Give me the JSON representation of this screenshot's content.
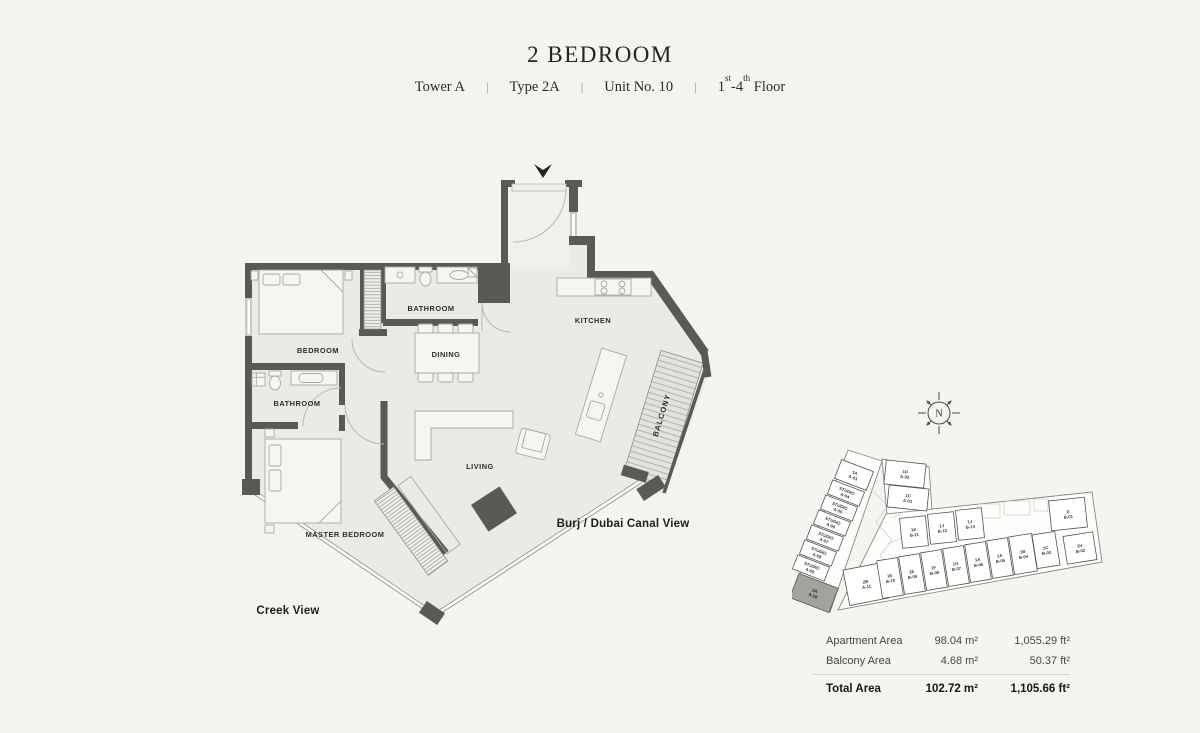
{
  "header": {
    "title": "2 BEDROOM",
    "subtitle": {
      "tower": "Tower A",
      "type": "Type 2A",
      "unit": "Unit No. 10",
      "sep": "|",
      "floor": {
        "n1": "1",
        "s1": "st",
        "n2": "-4",
        "s2": "th",
        "rest": " Floor"
      }
    }
  },
  "floorplan": {
    "rooms": {
      "bedroom": "BEDROOM",
      "bathroom1": "BATHROOM",
      "bathroom2": "BATHROOM",
      "dining": "DINING",
      "kitchen": "KITCHEN",
      "living": "LIVING",
      "master_bedroom": "MASTER BEDROOM",
      "balcony": "BALCONY"
    },
    "views": {
      "canal": "Burj / Dubai Canal View",
      "creek": "Creek View"
    }
  },
  "compass": {
    "label": "N"
  },
  "keyplan": {
    "units": [
      {
        "name": "1A",
        "code": "A-03",
        "x": 62,
        "y": 27,
        "r": 21,
        "w": 34,
        "h": 20,
        "hl": false
      },
      {
        "name": "STUDIO",
        "code": "A-04",
        "x": 54,
        "y": 45,
        "r": 21,
        "w": 34,
        "h": 15,
        "hl": false
      },
      {
        "name": "STUDIO",
        "code": "A-05",
        "x": 47,
        "y": 60,
        "r": 21,
        "w": 34,
        "h": 15,
        "hl": false
      },
      {
        "name": "STUDIO",
        "code": "A-06",
        "x": 40,
        "y": 75,
        "r": 21,
        "w": 34,
        "h": 15,
        "hl": false
      },
      {
        "name": "STUDIO",
        "code": "A-07",
        "x": 33,
        "y": 90,
        "r": 21,
        "w": 34,
        "h": 15,
        "hl": false
      },
      {
        "name": "STUDIO",
        "code": "A-08",
        "x": 26,
        "y": 105,
        "r": 21,
        "w": 34,
        "h": 15,
        "hl": false
      },
      {
        "name": "STUDIO",
        "code": "A-09",
        "x": 19,
        "y": 120,
        "r": 21,
        "w": 34,
        "h": 15,
        "hl": false
      },
      {
        "name": "2A",
        "code": "A-10",
        "x": 22,
        "y": 145,
        "r": 21,
        "w": 42,
        "h": 26,
        "hl": true
      },
      {
        "name": "1D",
        "code": "A-02",
        "x": 113,
        "y": 26,
        "r": 6,
        "w": 40,
        "h": 24,
        "hl": false
      },
      {
        "name": "1C",
        "code": "A-01",
        "x": 116,
        "y": 50,
        "r": 6,
        "w": 40,
        "h": 22,
        "hl": false
      },
      {
        "name": "1K",
        "code": "B-11",
        "x": 122,
        "y": 84,
        "r": -6,
        "w": 26,
        "h": 30,
        "hl": false
      },
      {
        "name": "1J",
        "code": "B-12",
        "x": 150,
        "y": 80,
        "r": -6,
        "w": 26,
        "h": 30,
        "hl": false
      },
      {
        "name": "1J",
        "code": "B-13",
        "x": 178,
        "y": 76,
        "r": -6,
        "w": 26,
        "h": 30,
        "hl": false
      },
      {
        "name": "1I",
        "code": "B-01",
        "x": 276,
        "y": 66,
        "r": -6,
        "w": 36,
        "h": 30,
        "hl": false
      },
      {
        "name": "2B",
        "code": "A-11",
        "x": 74,
        "y": 136,
        "r": -11,
        "w": 40,
        "h": 36,
        "hl": false
      },
      {
        "name": "1E",
        "code": "B-10",
        "x": 98,
        "y": 130,
        "r": -9,
        "w": 21,
        "h": 38,
        "hl": false
      },
      {
        "name": "1E",
        "code": "B-09",
        "x": 120,
        "y": 126,
        "r": -9,
        "w": 21,
        "h": 38,
        "hl": false
      },
      {
        "name": "1F",
        "code": "B-08",
        "x": 142,
        "y": 122,
        "r": -9,
        "w": 21,
        "h": 38,
        "hl": false
      },
      {
        "name": "1G",
        "code": "B-07",
        "x": 164,
        "y": 118,
        "r": -9,
        "w": 21,
        "h": 38,
        "hl": false
      },
      {
        "name": "1A",
        "code": "B-06",
        "x": 186,
        "y": 114,
        "r": -9,
        "w": 21,
        "h": 38,
        "hl": false
      },
      {
        "name": "1A",
        "code": "B-05",
        "x": 208,
        "y": 110,
        "r": -9,
        "w": 21,
        "h": 38,
        "hl": false
      },
      {
        "name": "1B",
        "code": "B-04",
        "x": 231,
        "y": 106,
        "r": -9,
        "w": 23,
        "h": 38,
        "hl": false
      },
      {
        "name": "1C",
        "code": "B-03",
        "x": 254,
        "y": 102,
        "r": -9,
        "w": 23,
        "h": 34,
        "hl": false
      },
      {
        "name": "1H",
        "code": "B-02",
        "x": 288,
        "y": 100,
        "r": -9,
        "w": 30,
        "h": 28,
        "hl": false
      }
    ]
  },
  "area_table": {
    "rows": [
      {
        "label": "Apartment Area",
        "m2": "98.04 m²",
        "ft2": "1,055.29 ft²"
      },
      {
        "label": "Balcony Area",
        "m2": "4.68 m²",
        "ft2": "50.37 ft²"
      },
      {
        "label": "Total Area",
        "m2": "102.72 m²",
        "ft2": "1,105.66 ft²"
      }
    ]
  }
}
